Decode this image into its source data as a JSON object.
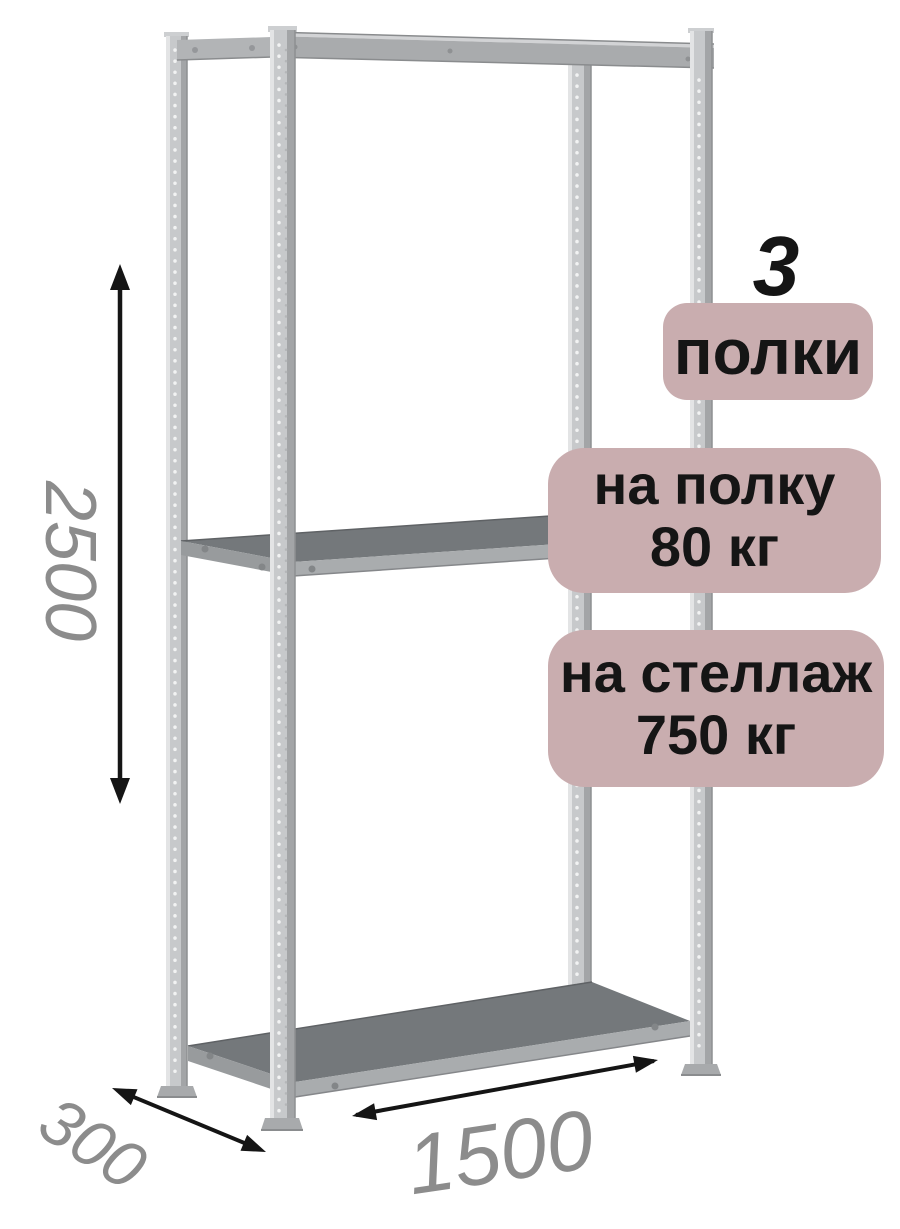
{
  "product": {
    "description": "metal boltless shelving rack, 3 shelves, isometric product illustration"
  },
  "badges": {
    "shelves": {
      "value": "3",
      "label": "полки"
    },
    "shelf_load": {
      "line1": "на полку",
      "line2": "80 кг"
    },
    "rack_load": {
      "line1": "на стеллаж",
      "line2": "750 кг"
    }
  },
  "dimensions": {
    "height": "2500",
    "depth": "300",
    "width": "1500"
  },
  "colors": {
    "background": "#ffffff",
    "badge_bg": "#c9adaf",
    "badge_text": "#151515",
    "dimension_text": "#8c8c8c",
    "arrow": "#151515",
    "frame_light": "#c7c9cb",
    "frame_highlight": "#e3e4e5",
    "frame_shadow": "#a3a5a7",
    "shelf_surface": "#74787b",
    "shelf_edge": "#a9acae"
  }
}
